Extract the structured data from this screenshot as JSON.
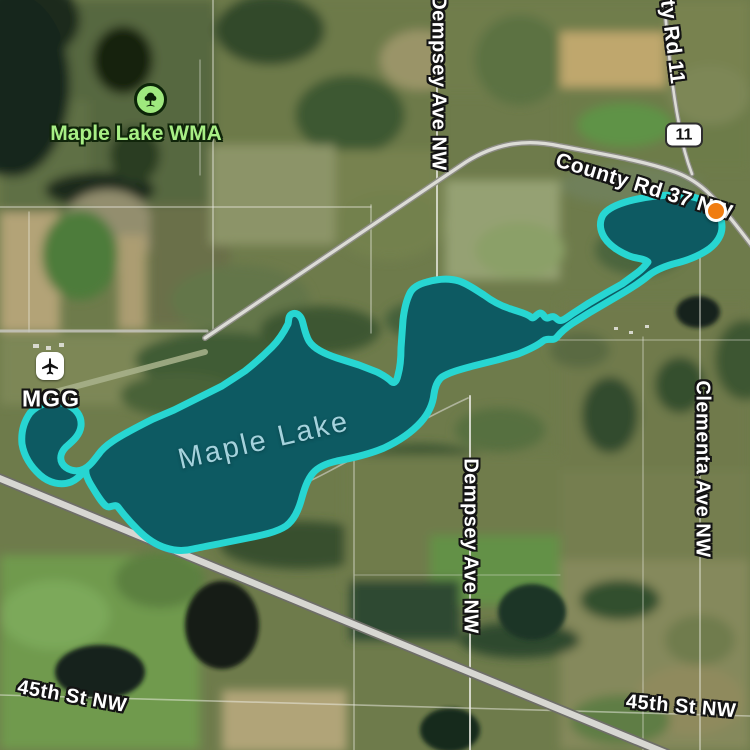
{
  "map": {
    "view": "satellite",
    "labels": {
      "wma": {
        "text": "Maple Lake WMA"
      },
      "lake": {
        "text": "Maple Lake"
      },
      "airport": {
        "text": "MGG"
      },
      "shield": {
        "text": "11"
      },
      "county_rd_11_partial": {
        "text": "ty Rd 11"
      },
      "county_rd_37": {
        "text": "County Rd 37 NW"
      },
      "dempsey_ave_north": {
        "text": "Dempsey Ave NW"
      },
      "dempsey_ave_south": {
        "text": "Dempsey Ave NW"
      },
      "clementa_ave": {
        "text": "Clementa Ave NW"
      },
      "st_45th_west": {
        "text": "45th St NW"
      },
      "st_45th_east": {
        "text": "45th St NW"
      }
    },
    "icons": {
      "wma_tree": "tree-icon",
      "airport": "airplane-icon",
      "marker": "orange-point-marker"
    },
    "colors": {
      "lake_fill": "#0d5a62",
      "lake_outline": "#27d6d2",
      "lake_label": "#a5d2dc",
      "wma_label": "#a8ef85",
      "marker": "#f07d12",
      "road_label": "#ffffff",
      "shield_bg": "#ffffff"
    }
  }
}
